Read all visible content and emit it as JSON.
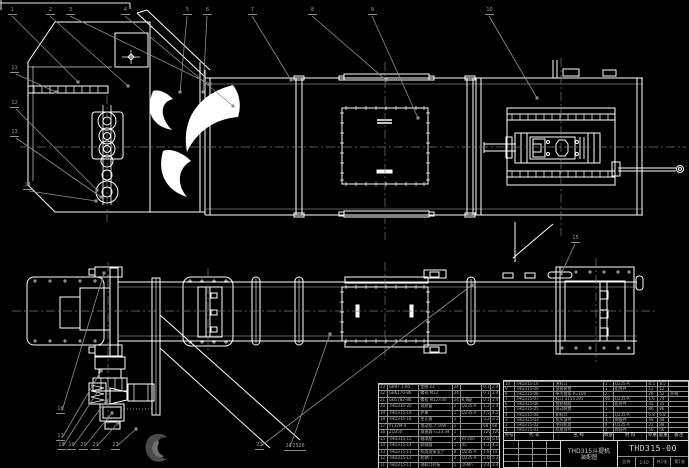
{
  "sheet": {
    "bg": "#000000",
    "line_color": "#ffffff",
    "leader_color": "#8f8f8f",
    "centerline_color": "#787878",
    "text_color": "#b3b3b3"
  },
  "title_block": {
    "product_title_line1": "THD315斗提机",
    "product_title_line2": "装配图",
    "drawing_no": "THD315-00",
    "footer_cells": [
      "比例",
      "1:10",
      "共1张",
      "第1张"
    ]
  },
  "bom_header": [
    "序号",
    "代 号",
    "名 称",
    "数量",
    "材 料",
    "单重",
    "总重",
    "备注"
  ],
  "bom_right_rows": [
    {
      "no": "10",
      "code": "THD315-10",
      "name": "进料斗",
      "qty": "1",
      "mat": "Q235-A",
      "w1": "8.5",
      "w2": "8.5",
      "rem": ""
    },
    {
      "no": "9",
      "code": "THD315-09",
      "name": "张紧装置",
      "qty": "1",
      "mat": "组合件",
      "w1": "12",
      "w2": "12",
      "rem": ""
    },
    {
      "no": "8",
      "code": "THD315-08",
      "name": "牵引链条 P=100",
      "qty": "2",
      "mat": "",
      "w1": "26",
      "w2": "52",
      "rem": "外购"
    },
    {
      "no": "7",
      "code": "THD315-07",
      "name": "料斗 315×195",
      "qty": "46",
      "mat": "Q235-A",
      "w1": "1.6",
      "w2": "74",
      "rem": ""
    },
    {
      "no": "6",
      "code": "THD315-06",
      "name": "链轮轴组",
      "qty": "1",
      "mat": "组合件",
      "w1": "35",
      "w2": "35",
      "rem": ""
    },
    {
      "no": "5",
      "code": "THD315-05",
      "name": "驱动装置",
      "qty": "1",
      "mat": "",
      "w1": "86",
      "w2": "86",
      "rem": ""
    },
    {
      "no": "4",
      "code": "THD315-04",
      "name": "卸料口",
      "qty": "1",
      "mat": "Q235-A",
      "w1": "6.8",
      "w2": "6.8",
      "rem": ""
    },
    {
      "no": "3",
      "code": "THD315-03",
      "name": "机头部件",
      "qty": "1",
      "mat": "焊接件",
      "w1": "48",
      "w2": "48",
      "rem": ""
    },
    {
      "no": "2",
      "code": "THD315-02",
      "name": "中间机筒",
      "qty": "4",
      "mat": "Q235-A",
      "w1": "22",
      "w2": "88",
      "rem": ""
    },
    {
      "no": "1",
      "code": "THD315-01",
      "name": "机座部件",
      "qty": "1",
      "mat": "焊接件",
      "w1": "56",
      "w2": "56",
      "rem": ""
    }
  ],
  "bom_left_rows": [
    {
      "no": "23",
      "code": "GB97.1-85",
      "name": "垫圈 12",
      "qty": "24",
      "mat": "",
      "w1": "0.1",
      "w2": "2.4"
    },
    {
      "no": "22",
      "code": "GB6170-86",
      "name": "螺母 M12",
      "qty": "24",
      "mat": "",
      "w1": "0.1",
      "w2": "2.4"
    },
    {
      "no": "21",
      "code": "GB5782-86",
      "name": "螺栓 M12×40",
      "qty": "24",
      "mat": "8.8级",
      "w1": "0.1",
      "w2": "2.4"
    },
    {
      "no": "20",
      "code": "THD315-20",
      "name": "观察窗",
      "qty": "2",
      "mat": "Q235-A",
      "w1": "1.2",
      "w2": "2.4"
    },
    {
      "no": "19",
      "code": "THD315-19",
      "name": "护罩",
      "qty": "1",
      "mat": "Q235-A",
      "w1": "4.5",
      "w2": "4.5"
    },
    {
      "no": "18",
      "code": "THD315-18",
      "name": "逆止器",
      "qty": "1",
      "mat": "",
      "w1": "3.2",
      "w2": "3.2"
    },
    {
      "no": "17",
      "code": "Y132M-4",
      "name": "电动机 7.5kW",
      "qty": "1",
      "mat": "",
      "w1": "68",
      "w2": "68"
    },
    {
      "no": "16",
      "code": "ZQ350",
      "name": "减速器 i=23.34",
      "qty": "1",
      "mat": "",
      "w1": "120",
      "w2": "120"
    },
    {
      "no": "15",
      "code": "THD315-15",
      "name": "轴承座",
      "qty": "2",
      "mat": "HT200",
      "w1": "2.8",
      "w2": "5.6"
    },
    {
      "no": "14",
      "code": "THD315-14",
      "name": "联轴器",
      "qty": "1",
      "mat": "45",
      "w1": "4.2",
      "w2": "4.2"
    },
    {
      "no": "13",
      "code": "THD315-13",
      "name": "机筒连接法兰",
      "qty": "8",
      "mat": "Q235-A",
      "w1": "1.8",
      "w2": "14.4"
    },
    {
      "no": "12",
      "code": "THD315-12",
      "name": "检修门",
      "qty": "2",
      "mat": "Q235-A",
      "w1": "2.6",
      "w2": "5.2"
    },
    {
      "no": "11",
      "code": "THD315-11",
      "name": "进料口衬板",
      "qty": "1",
      "mat": "16Mn",
      "w1": "3.4",
      "w2": "3.4"
    }
  ],
  "balloons": [
    {
      "label": "1",
      "x": 8,
      "y": 8
    },
    {
      "label": "2",
      "x": 46,
      "y": 8
    },
    {
      "label": "3",
      "x": 66,
      "y": 8
    },
    {
      "label": "4",
      "x": 121,
      "y": 8
    },
    {
      "label": "5",
      "x": 183,
      "y": 8
    },
    {
      "label": "6",
      "x": 203,
      "y": 8
    },
    {
      "label": "7",
      "x": 248,
      "y": 8
    },
    {
      "label": "8",
      "x": 308,
      "y": 8
    },
    {
      "label": "9",
      "x": 368,
      "y": 8
    },
    {
      "label": "10",
      "x": 485,
      "y": 8
    },
    {
      "label": "11",
      "x": 10,
      "y": 66
    },
    {
      "label": "12",
      "x": 10,
      "y": 101
    },
    {
      "label": "13",
      "x": 10,
      "y": 130
    },
    {
      "label": "14",
      "x": 23,
      "y": 183
    },
    {
      "label": "15",
      "x": 571,
      "y": 236
    },
    {
      "label": "16",
      "x": 56,
      "y": 407
    },
    {
      "label": "17",
      "x": 56,
      "y": 434
    },
    {
      "label": "18",
      "x": 57,
      "y": 443
    },
    {
      "label": "19",
      "x": 67,
      "y": 443
    },
    {
      "label": "20",
      "x": 79,
      "y": 443
    },
    {
      "label": "21",
      "x": 91,
      "y": 443
    },
    {
      "label": "22",
      "x": 111,
      "y": 443
    },
    {
      "label": "23",
      "x": 255,
      "y": 443
    },
    {
      "label": "24",
      "x": 284,
      "y": 444
    },
    {
      "label": "25",
      "x": 291,
      "y": 444
    },
    {
      "label": "26",
      "x": 297,
      "y": 444
    }
  ],
  "leaders": [
    {
      "x1": 12,
      "y1": 16,
      "x2": 78,
      "y2": 82
    },
    {
      "x1": 50,
      "y1": 16,
      "x2": 128,
      "y2": 86
    },
    {
      "x1": 70,
      "y1": 16,
      "x2": 210,
      "y2": 84
    },
    {
      "x1": 125,
      "y1": 16,
      "x2": 233,
      "y2": 106
    },
    {
      "x1": 187,
      "y1": 16,
      "x2": 180,
      "y2": 92
    },
    {
      "x1": 207,
      "y1": 16,
      "x2": 203,
      "y2": 92
    },
    {
      "x1": 252,
      "y1": 16,
      "x2": 291,
      "y2": 80
    },
    {
      "x1": 312,
      "y1": 16,
      "x2": 386,
      "y2": 80
    },
    {
      "x1": 372,
      "y1": 16,
      "x2": 418,
      "y2": 118
    },
    {
      "x1": 489,
      "y1": 16,
      "x2": 537,
      "y2": 98
    },
    {
      "x1": 16,
      "y1": 74,
      "x2": 56,
      "y2": 92
    },
    {
      "x1": 16,
      "y1": 109,
      "x2": 97,
      "y2": 190
    },
    {
      "x1": 16,
      "y1": 138,
      "x2": 101,
      "y2": 197
    },
    {
      "x1": 29,
      "y1": 191,
      "x2": 96,
      "y2": 201
    },
    {
      "x1": 575,
      "y1": 244,
      "x2": 561,
      "y2": 274
    },
    {
      "x1": 62,
      "y1": 411,
      "x2": 104,
      "y2": 273
    },
    {
      "x1": 62,
      "y1": 438,
      "x2": 101,
      "y2": 371
    },
    {
      "x1": 63,
      "y1": 446,
      "x2": 98,
      "y2": 391
    },
    {
      "x1": 73,
      "y1": 446,
      "x2": 106,
      "y2": 401
    },
    {
      "x1": 85,
      "y1": 446,
      "x2": 112,
      "y2": 413
    },
    {
      "x1": 97,
      "y1": 446,
      "x2": 118,
      "y2": 423
    },
    {
      "x1": 117,
      "y1": 446,
      "x2": 136,
      "y2": 429
    },
    {
      "x1": 261,
      "y1": 446,
      "x2": 472,
      "y2": 285
    },
    {
      "x1": 290,
      "y1": 447,
      "x2": 330,
      "y2": 334
    }
  ]
}
